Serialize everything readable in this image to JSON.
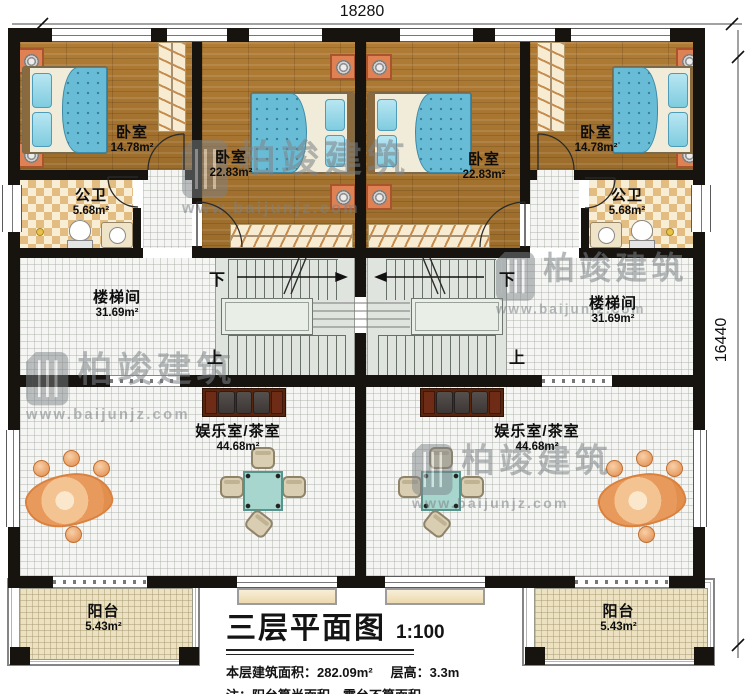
{
  "plan": {
    "dimensions": {
      "top": "18280",
      "right": "16440"
    },
    "stair_direction": {
      "down": "下",
      "up": "上"
    },
    "rooms": {
      "bedroom_small_left": {
        "name": "卧室",
        "area": "14.78m²"
      },
      "bedroom_large_left": {
        "name": "卧室",
        "area": "22.83m²"
      },
      "bedroom_large_right": {
        "name": "卧室",
        "area": "22.83m²"
      },
      "bedroom_small_right": {
        "name": "卧室",
        "area": "14.78m²"
      },
      "bathroom_left": {
        "name": "公卫",
        "area": "5.68m²"
      },
      "bathroom_right": {
        "name": "公卫",
        "area": "5.68m²"
      },
      "stairwell_left": {
        "name": "楼梯间",
        "area": "31.69m²"
      },
      "stairwell_right": {
        "name": "楼梯间",
        "area": "31.69m²"
      },
      "tearoom_left": {
        "name": "娱乐室/茶室",
        "area": "44.68m²"
      },
      "tearoom_right": {
        "name": "娱乐室/茶室",
        "area": "44.68m²"
      },
      "balcony_left": {
        "name": "阳台",
        "area": "5.43m²"
      },
      "balcony_right": {
        "name": "阳台",
        "area": "5.43m²"
      }
    }
  },
  "title_block": {
    "title": "三层平面图",
    "scale": "1:100",
    "area_text": "本层建筑面积：282.09m²",
    "floor_height_text": "层高：3.3m",
    "note": "注：阳台算半面积，露台不算面积"
  },
  "watermark": {
    "brand": "柏竣建筑",
    "url": "www.baijunjz.com"
  },
  "colors": {
    "wall": "#17140f",
    "wood_floor": "#a8762f",
    "bed_blanket": "#69bcd6",
    "nightstand_orange": "#df8152",
    "tea_table": "#a6d6cd",
    "rug_orange": "#e89a5c",
    "watermark_grey": "#7d8287"
  }
}
